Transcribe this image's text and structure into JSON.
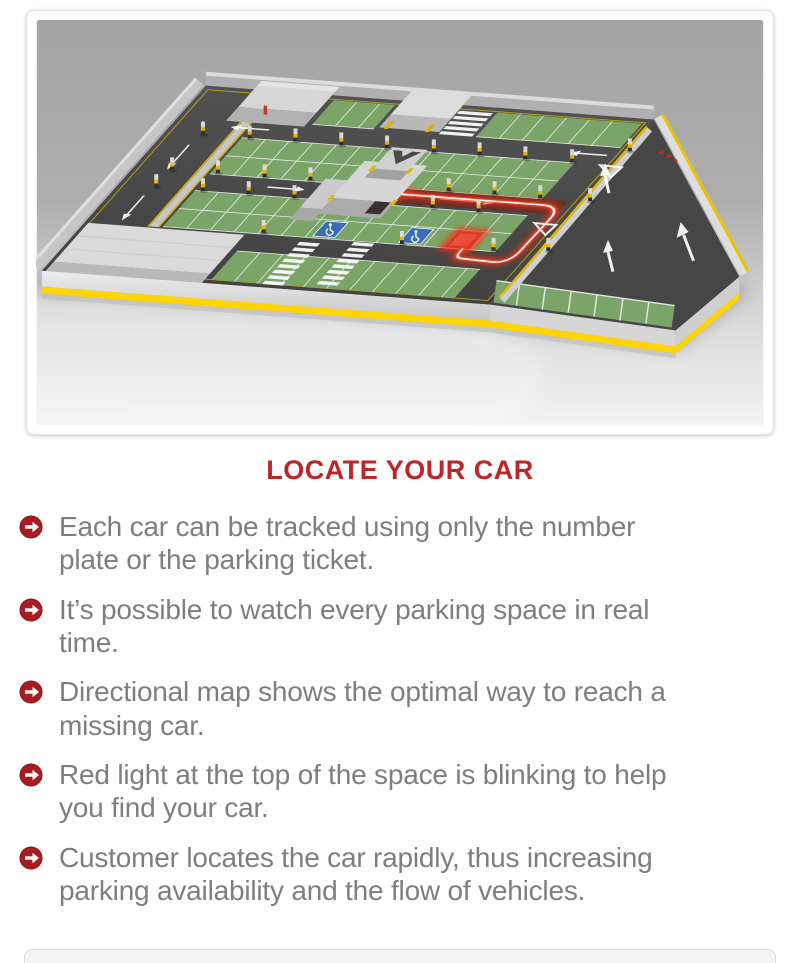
{
  "illustration": {
    "label": "3D isometric map of a parking deck: green parking bays, dark driving lanes with white arrows, concrete walls with yellow safety stripes, two blue accessible spaces, and a glowing red guidance path leading from the elevator building to a red-highlighted parking space where the searched car is parked",
    "colors": {
      "asphalt": "#4a4a4a",
      "parking_bay_green": "#7ba468",
      "wall_concrete": "#d6d6d6",
      "safety_yellow": "#f7c900",
      "accessible_blue": "#3a6cb8",
      "located_car_red": "#d63726",
      "guidance_glow_red": "#ff2a10"
    }
  },
  "heading": {
    "text": "LOCATE YOUR CAR",
    "color": "#bf2428"
  },
  "features": {
    "bullet_icon": "arrow-right-circle-icon",
    "bullet_color": "#a81d22",
    "text_color": "#7e7e7e",
    "items": [
      "Each car can be tracked using only the number plate or the parking ticket.",
      "It’s possible to watch every parking space in real time.",
      "Directional map shows the optimal way to reach a missing car.",
      "Red light at the top of the space is blinking to help you find your car.",
      "Customer locates the car rapidly, thus increasing parking availability and the flow of vehicles."
    ]
  }
}
